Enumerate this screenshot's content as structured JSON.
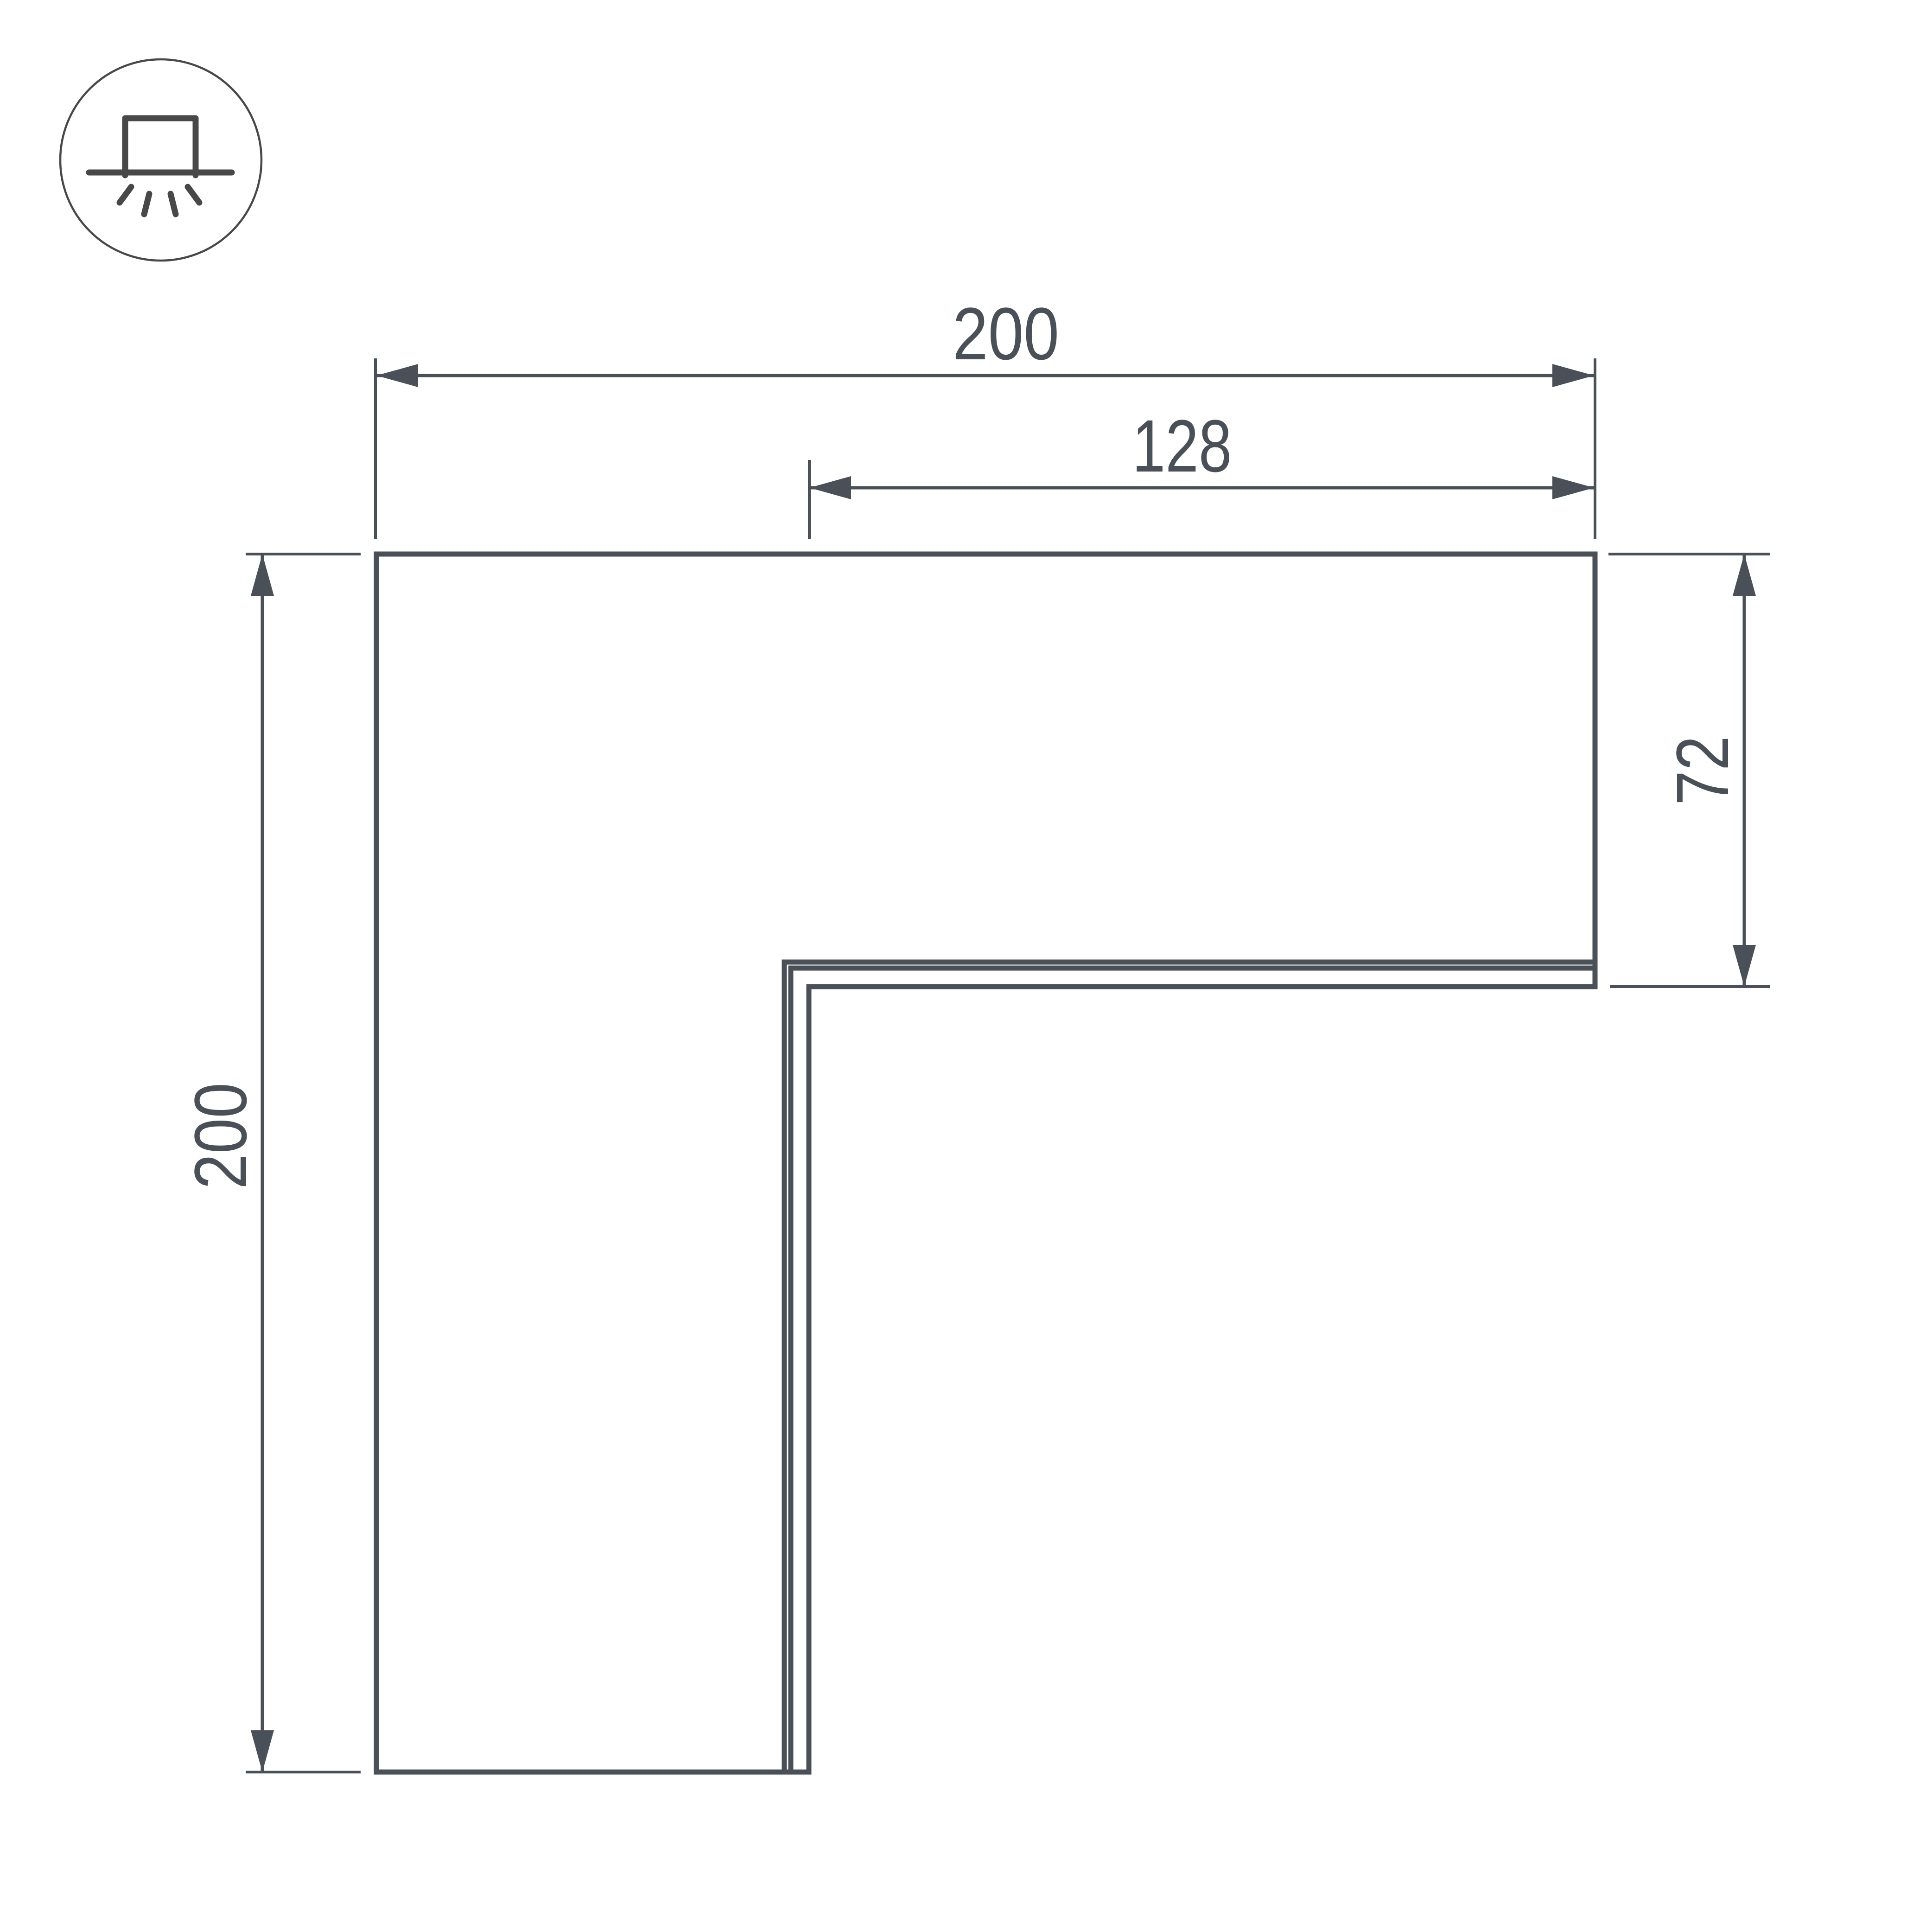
{
  "drawing": {
    "type": "technical-dimension-drawing",
    "subject": "L-shaped corner profile connector (top view)",
    "background": "#ffffff"
  },
  "icon": {
    "name": "surface-mounted-light-icon",
    "description": "circle badge with surface-mount downlight glyph (box on ceiling line with 4 light rays)"
  },
  "dimensions": {
    "top_width": "200",
    "inner_width": "128",
    "right_height": "72",
    "left_height": "200"
  },
  "colors": {
    "line": "#4a5057",
    "icon": "#484848",
    "background": "#ffffff"
  }
}
